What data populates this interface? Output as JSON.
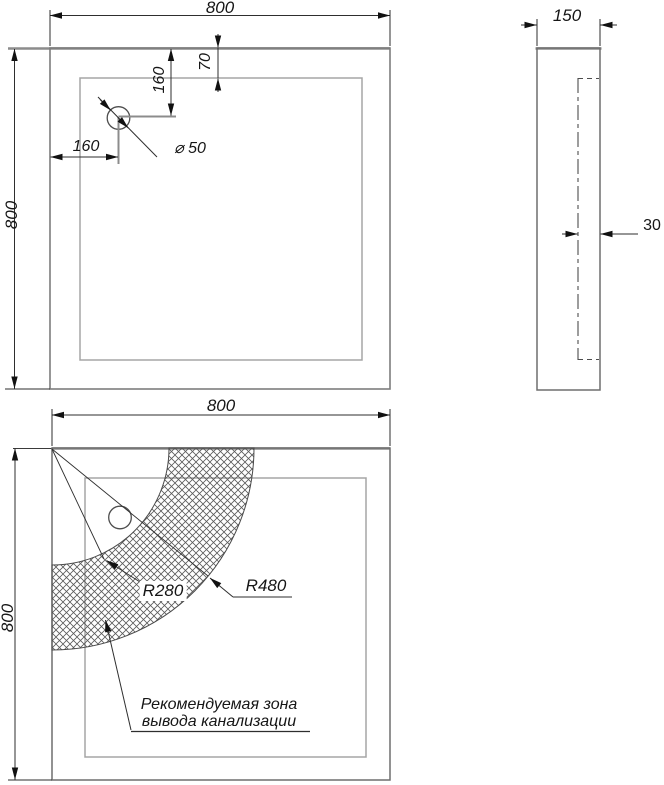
{
  "views": {
    "top": {
      "width": "800",
      "height": "800",
      "rim_offset": "70",
      "drain_offset_vertical": "160",
      "drain_offset_horizontal": "160",
      "drain_diameter": "⌀ 50"
    },
    "side": {
      "depth": "150",
      "base_recess": "30"
    },
    "bottom": {
      "width": "800",
      "height": "800",
      "inner_radius": "R280",
      "outer_radius": "R480",
      "zone_note_line1": "Рекомендуемая зона",
      "zone_note_line2": "вывода канализации"
    }
  },
  "colors": {
    "background": "#ffffff",
    "edge_main": "#8c8c8c",
    "edge_inner": "#a5a5a5",
    "dimension_line": "#2e2e2e",
    "text": "#161616"
  }
}
